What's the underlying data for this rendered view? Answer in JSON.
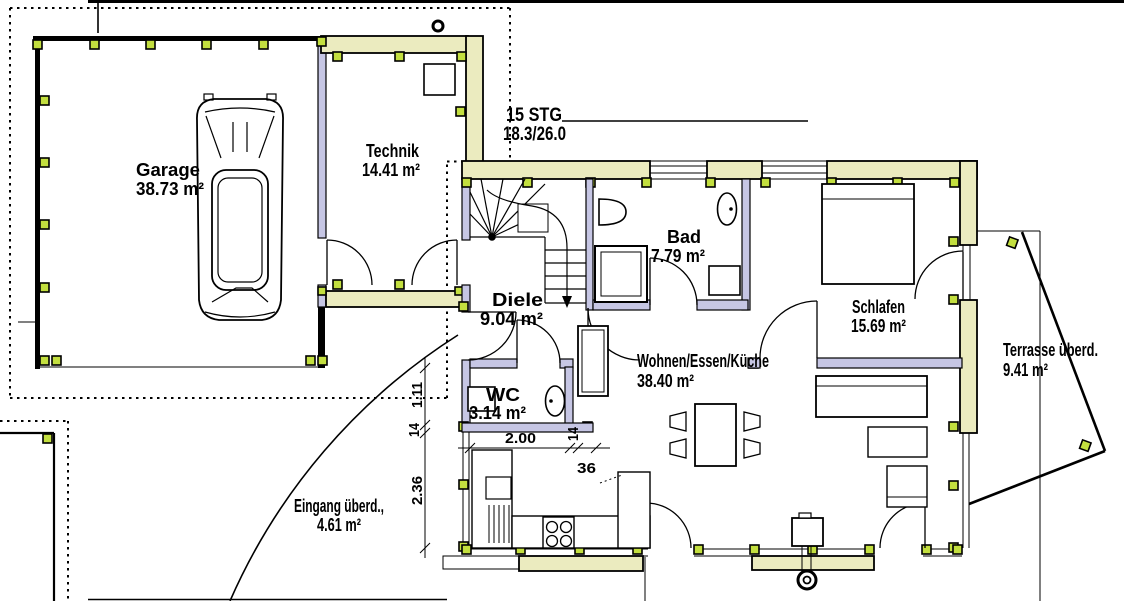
{
  "plan": {
    "type": "floor-plan",
    "rooms": [
      {
        "name": "Garage",
        "area": "38.73 m²"
      },
      {
        "name": "Technik",
        "area": "14.41 m²"
      },
      {
        "name": "Diele",
        "area": "9.04 m²"
      },
      {
        "name": "WC",
        "area": "3.14 m²"
      },
      {
        "name": "Bad",
        "area": "7.79 m²"
      },
      {
        "name": "Schlafen",
        "area": "15.69 m²"
      },
      {
        "name": "Wohnen/Essen/Küche",
        "area": "38.40 m²"
      },
      {
        "name": "Terrasse überd.",
        "area": "9.41 m²"
      },
      {
        "name": "Eingang überd.,",
        "area": "4.61 m²"
      }
    ],
    "stair_note": {
      "steps": "15 STG",
      "rise_run": "18.3/26.0"
    },
    "dimensions": {
      "horizontal": [
        "2.00",
        "14",
        "36"
      ],
      "vertical": [
        "1.11",
        "14",
        "2.36"
      ]
    },
    "colors": {
      "exterior_wall": "#ebebbf",
      "interior_wall": "#c6c6e4",
      "post": "#c3df3f",
      "line": "#000000"
    }
  }
}
